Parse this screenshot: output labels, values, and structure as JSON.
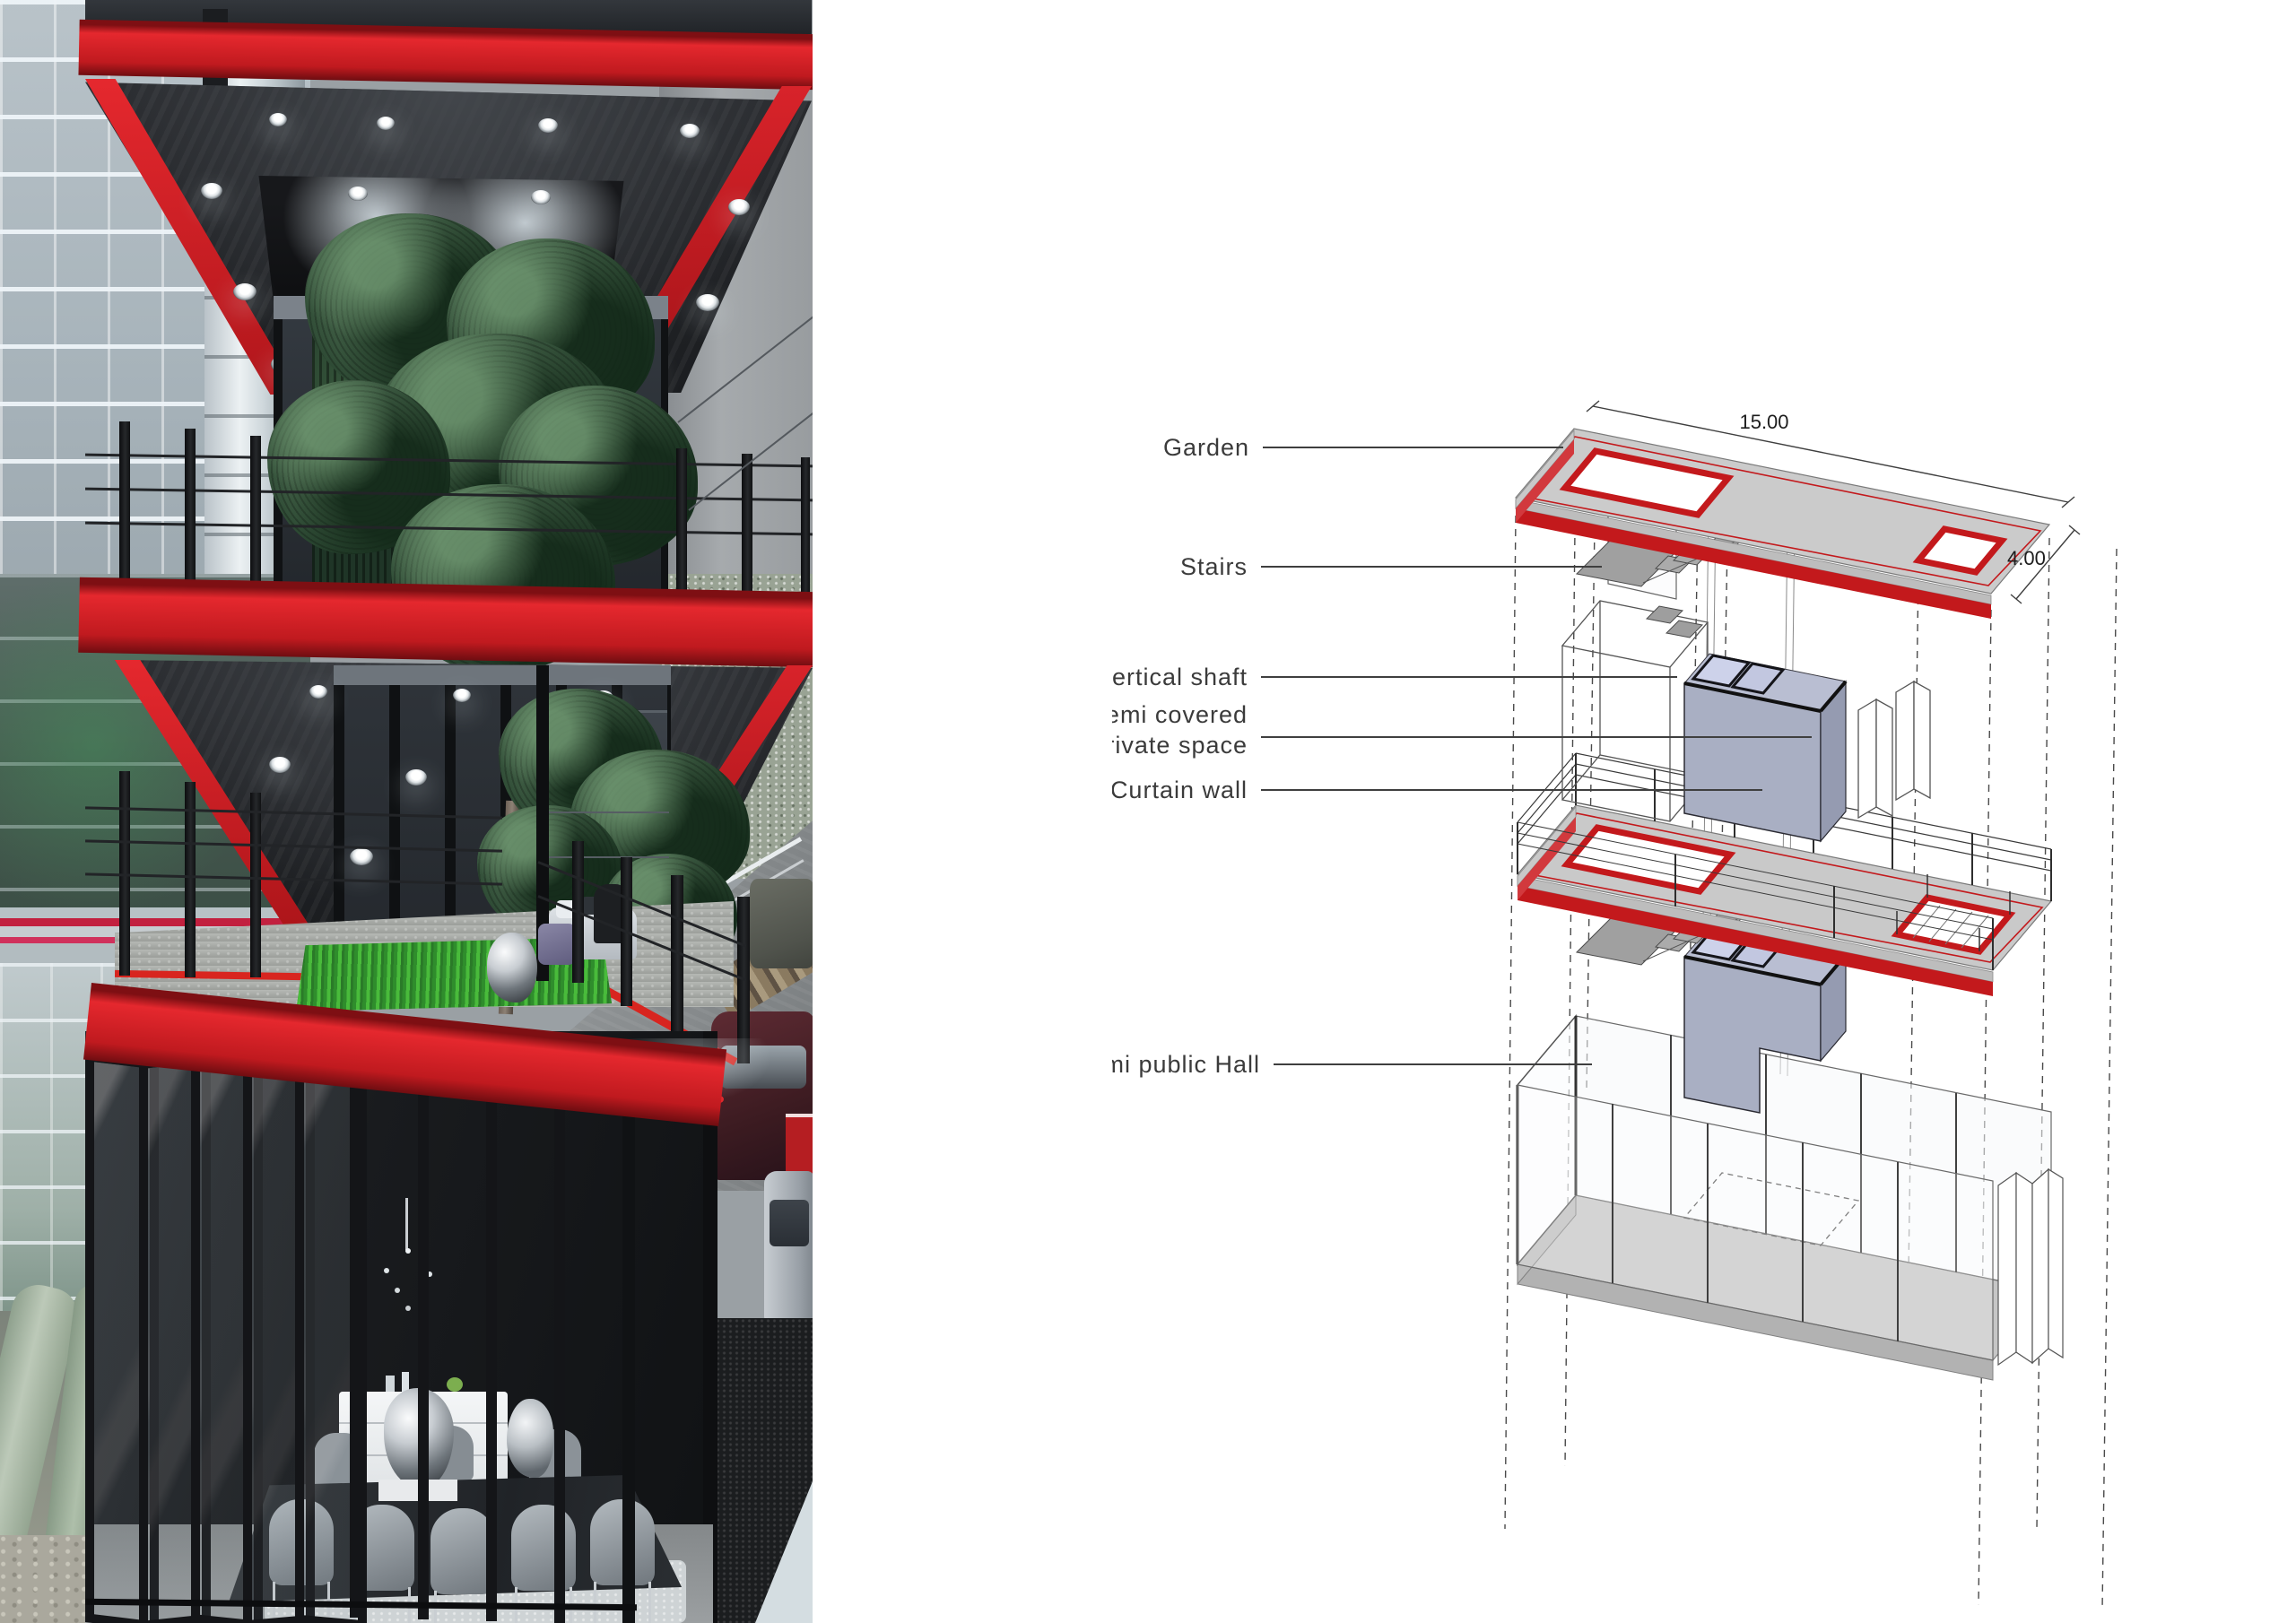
{
  "diagram": {
    "labels": {
      "garden": "Garden",
      "stairs": "Stairs",
      "vertical_shaft": "vertical shaft",
      "semi_covered_line1": "semi covered",
      "semi_covered_line2": "private space",
      "curtain_wall": "Curtain wall",
      "semi_public_hall": "Semi public Hall"
    },
    "dimensions": {
      "length": "15.00",
      "depth": "4.00"
    },
    "colors": {
      "accent_red": "#c3191c",
      "slab_gray": "#cbcbcb",
      "volume_blue_gray": "#a9afc3",
      "leader_line": "#3f3f3f",
      "label_text": "#3b3b3b"
    }
  },
  "photo": {
    "palette": {
      "slab_red": "#df2127",
      "soffit_dark": "#232528",
      "foliage_green": "#31503a",
      "grass_green": "#45b637",
      "concrete_gray": "#b7bab6",
      "glass_dark": "#2c3137"
    }
  }
}
